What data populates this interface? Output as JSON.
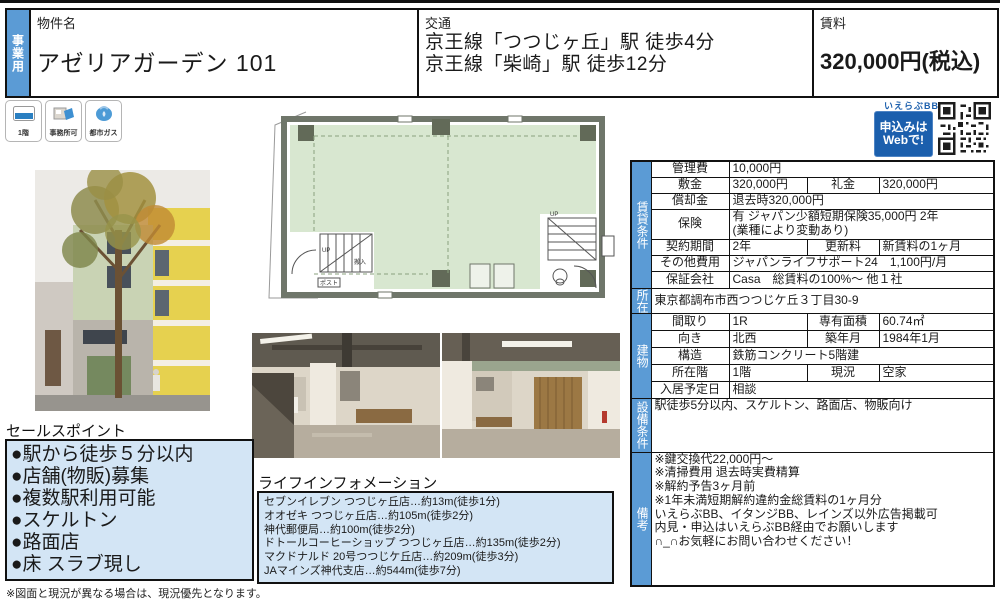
{
  "colors": {
    "accent_blue": "#5b9bd5",
    "button_blue": "#1b5fad",
    "panel_blue": "#d3e5f5",
    "plan_green": "#d8e7d0"
  },
  "header": {
    "category_tab": "事業用",
    "property_name_label": "物件名",
    "property_name": "アゼリアガーデン 101",
    "transport_label": "交通",
    "transport_lines": [
      "京王線「つつじヶ丘」駅 徒歩4分",
      "京王線「柴崎」駅 徒歩12分"
    ],
    "rent_label": "賃料",
    "rent_value": "320,000円(税込)"
  },
  "badges": [
    {
      "label": "1階",
      "icon": "floor-icon"
    },
    {
      "label": "事務所可",
      "icon": "office-icon"
    },
    {
      "label": "都市ガス",
      "icon": "gas-icon"
    }
  ],
  "web_apply": {
    "brand": "いえらぶBB",
    "button_line1": "申込みは",
    "button_line2": "Webで!"
  },
  "floorplan_labels": {
    "up_left": "UP",
    "up_right": "UP",
    "delivery": "搬入",
    "post": "ポスト"
  },
  "conditions": {
    "section_label": "賃貸条件",
    "management_fee_label": "管理費",
    "management_fee": "10,000円",
    "deposit_label": "敷金",
    "deposit": "320,000円",
    "key_money_label": "礼金",
    "key_money": "320,000円",
    "amortization_label": "償却金",
    "amortization": "退去時320,000円",
    "insurance_label": "保険",
    "insurance_line1": "有 ジャパン少額短期保険35,000円 2年",
    "insurance_line2": "(業種により変動あり)",
    "contract_period_label": "契約期間",
    "contract_period": "2年",
    "renewal_fee_label": "更新料",
    "renewal_fee": "新賃料の1ヶ月",
    "other_fees_label": "その他費用",
    "other_fees": "ジャパンライフサポート24　1,100円/月",
    "guarantor_label": "保証会社",
    "guarantor": "Casa　総賃料の100%〜 他１社"
  },
  "location": {
    "section_label": "所在",
    "address": "東京都調布市西つつじケ丘３丁目30-9"
  },
  "building": {
    "section_label": "建物",
    "layout_label": "間取り",
    "layout": "1R",
    "area_label": "専有面積",
    "area": "60.74㎡",
    "direction_label": "向き",
    "direction": "北西",
    "built_label": "築年月",
    "built": "1984年1月",
    "structure_label": "構造",
    "structure": "鉄筋コンクリート5階建",
    "floor_label": "所在階",
    "floor": "1階",
    "status_label": "現況",
    "status": "空家",
    "move_in_label": "入居予定日",
    "move_in": "相談"
  },
  "equipment": {
    "section_label": "設備条件",
    "text": "駅徒歩5分以内、スケルトン、路面店、物販向け"
  },
  "remarks": {
    "section_label": "備考",
    "lines": [
      "※鍵交換代22,000円〜",
      "※清掃費用 退去時実費精算",
      "※解約予告3ヶ月前",
      "※1年未満短期解約違約金総賃料の1ヶ月分",
      "いえらぶBB、イタンジBB、レインズ以外広告掲載可",
      "内見・申込はいえらぶBB経由でお願いします",
      "∩_∩お気軽にお問い合わせください！"
    ]
  },
  "sales_points": {
    "title": "セールスポイント",
    "items": [
      "●駅から徒歩５分以内",
      "●店舗(物販)募集",
      "●複数駅利用可能",
      "●スケルトン",
      "●路面店",
      "●床 スラブ現し"
    ]
  },
  "life_info": {
    "title": "ライフインフォメーション",
    "items": [
      "セブンイレブン つつじヶ丘店…約13m(徒歩1分)",
      "オオゼキ つつじヶ丘店…約105m(徒歩2分)",
      "神代郵便局…約100m(徒歩2分)",
      "ドトールコーヒーショップ つつじヶ丘店…約135m(徒歩2分)",
      "マクドナルド 20号つつじケ丘店…約209m(徒歩3分)",
      "JAマインズ神代支店…約544m(徒歩7分)"
    ]
  },
  "footer_note": "※図面と現況が異なる場合は、現況優先となります。"
}
